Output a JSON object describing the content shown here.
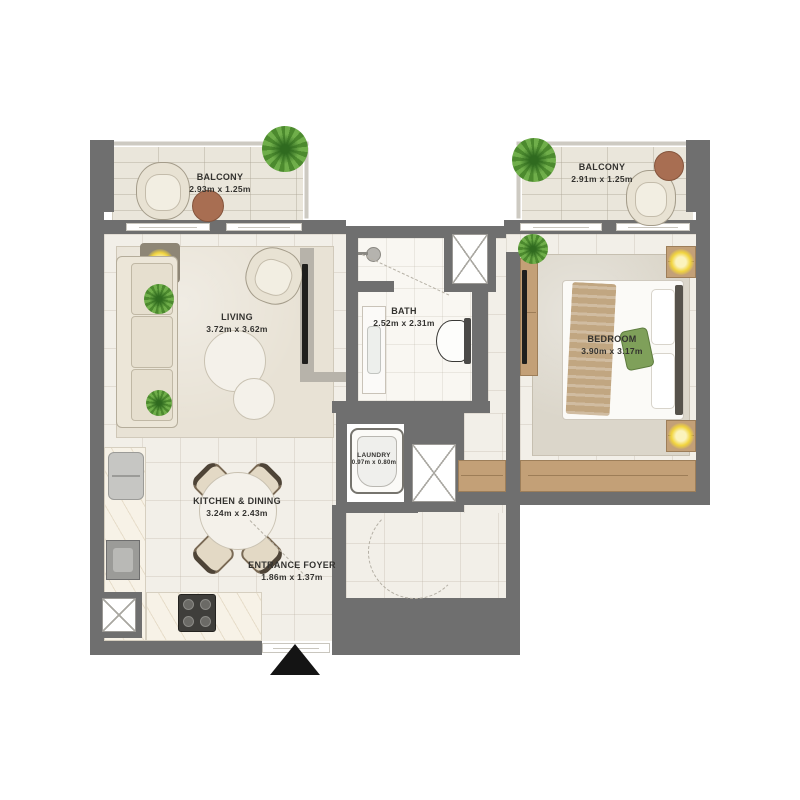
{
  "rooms": {
    "balcony_left": {
      "label": "BALCONY",
      "dims": "2.93m x 1.25m"
    },
    "balcony_right": {
      "label": "BALCONY",
      "dims": "2.91m x 1.25m"
    },
    "living": {
      "label": "LIVING",
      "dims": "3.72m x 3.62m"
    },
    "bath": {
      "label": "BATH",
      "dims": "2.52m x 2.31m"
    },
    "bedroom": {
      "label": "BEDROOM",
      "dims": "3.90m x 3.17m"
    },
    "laundry": {
      "label": "LAUNDRY",
      "dims": "0.97m x 0.80m"
    },
    "kitchen_dining": {
      "label": "KITCHEN & DINING",
      "dims": "3.24m x 2.43m"
    },
    "entrance_foyer": {
      "label": "ENTRANCE FOYER",
      "dims": "1.86m x 1.37m"
    }
  },
  "colors": {
    "wall": "#6f6f6f",
    "floor": "#f2efe8",
    "balcony_floor": "#eae6db",
    "wood": "#c3a077",
    "plant_green": "#6fae4a",
    "lamp_glow": "#f1d43e",
    "entry_marker": "#141414",
    "label_text": "#33322f"
  }
}
